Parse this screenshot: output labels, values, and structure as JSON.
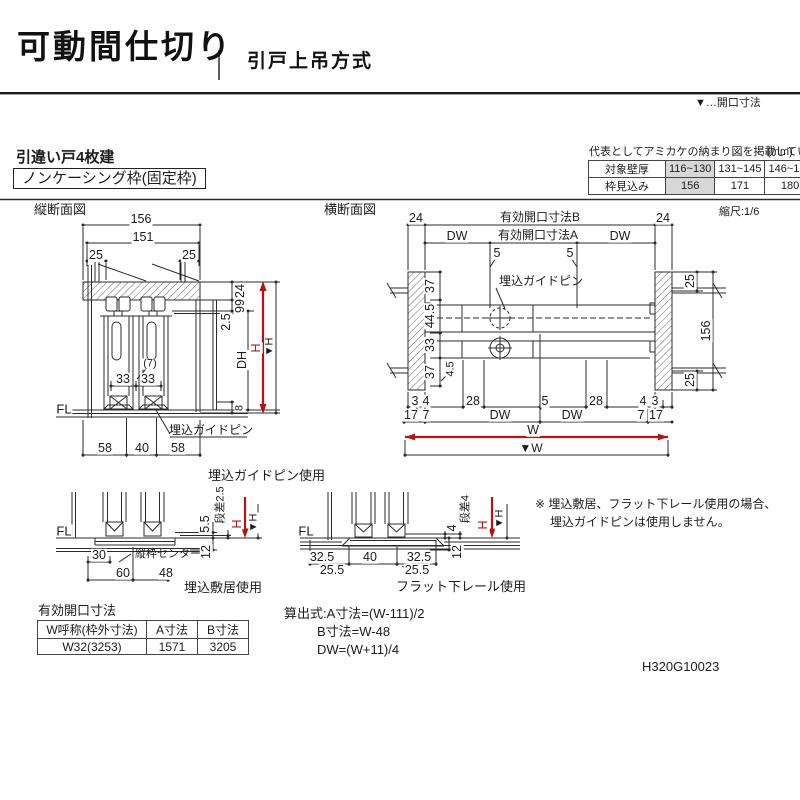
{
  "header": {
    "title": "可動間仕切り",
    "subtitle": "引戸上吊方式",
    "legend": "▼…開口寸法"
  },
  "section": {
    "door_type": "引違い戸4枚建",
    "frame_type": "ノンケーシング枠(固定枠)"
  },
  "wall_table": {
    "caption": "代表としてアミカケの納まり図を掲載しています。",
    "unit": "(mm)",
    "rows": [
      [
        "対象壁厚",
        "116~130",
        "131~145",
        "146~160"
      ],
      [
        "枠見込み",
        "156",
        "171",
        "180"
      ]
    ]
  },
  "vsection": {
    "title": "縦断面図",
    "d156": "156",
    "d151": "151",
    "d25l": "25",
    "d25r": "25",
    "d24": "24",
    "d99": "99",
    "d2_5": "2.5",
    "dh": "DH",
    "h": "H",
    "h_open": "▼H",
    "d7": "(7)",
    "d33l": "33",
    "d33r": "33",
    "fl": "FL",
    "d8": "8",
    "pin": "埋込ガイドピン",
    "d58l": "58",
    "d40": "40",
    "d58r": "58"
  },
  "hsection": {
    "title": "横断面図",
    "scale": "縮尺:1/6",
    "d24l": "24",
    "d24r": "24",
    "open_b": "有効開口寸法B",
    "open_a": "有効開口寸法A",
    "dwl": "DW",
    "dwr": "DW",
    "d5l": "5",
    "d5r": "5",
    "pin": "埋込ガイドピン",
    "side": [
      "37",
      "44.5",
      "33",
      "37"
    ],
    "d4_5": "4.5",
    "right": [
      "25",
      "156",
      "25"
    ],
    "r1": [
      "3",
      "4",
      "28",
      "5",
      "28",
      "4",
      "3"
    ],
    "r2": [
      "17",
      "7",
      "DW",
      "DW",
      "7",
      "17"
    ],
    "w": "W",
    "w_open": "▼W"
  },
  "details": {
    "pin_usage": "埋込ガイドピン使用",
    "sill": {
      "fl": "FL",
      "d5_5": "5.5",
      "step": "段差2.5",
      "h": "H",
      "h_open": "▼H",
      "d12": "12",
      "d30": "30",
      "center": "縦枠センター",
      "d60": "60",
      "d48": "48",
      "caption": "埋込敷居使用"
    },
    "rail": {
      "fl": "FL",
      "step": "段差4",
      "d4": "4",
      "h": "H",
      "h_open": "▼H",
      "d12": "12",
      "d32l": "32.5",
      "d40": "40",
      "d32r": "32.5",
      "d25l": "25.5",
      "d25r": "25.5",
      "caption": "フラット下レール使用"
    }
  },
  "note": {
    "line1": "※ 埋込敷居、フラット下レール使用の場合、",
    "line2": "埋込ガイドピンは使用しません。"
  },
  "opening_table": {
    "title": "有効開口寸法",
    "headers": [
      "W呼称(枠外寸法)",
      "A寸法",
      "B寸法"
    ],
    "row": [
      "W32(3253)",
      "1571",
      "3205"
    ]
  },
  "formulas": {
    "l1": "算出式:A寸法=(W-111)/2",
    "l2": "B寸法=W-48",
    "l3": "DW=(W+11)/4"
  },
  "doc_code": "H320G10023"
}
